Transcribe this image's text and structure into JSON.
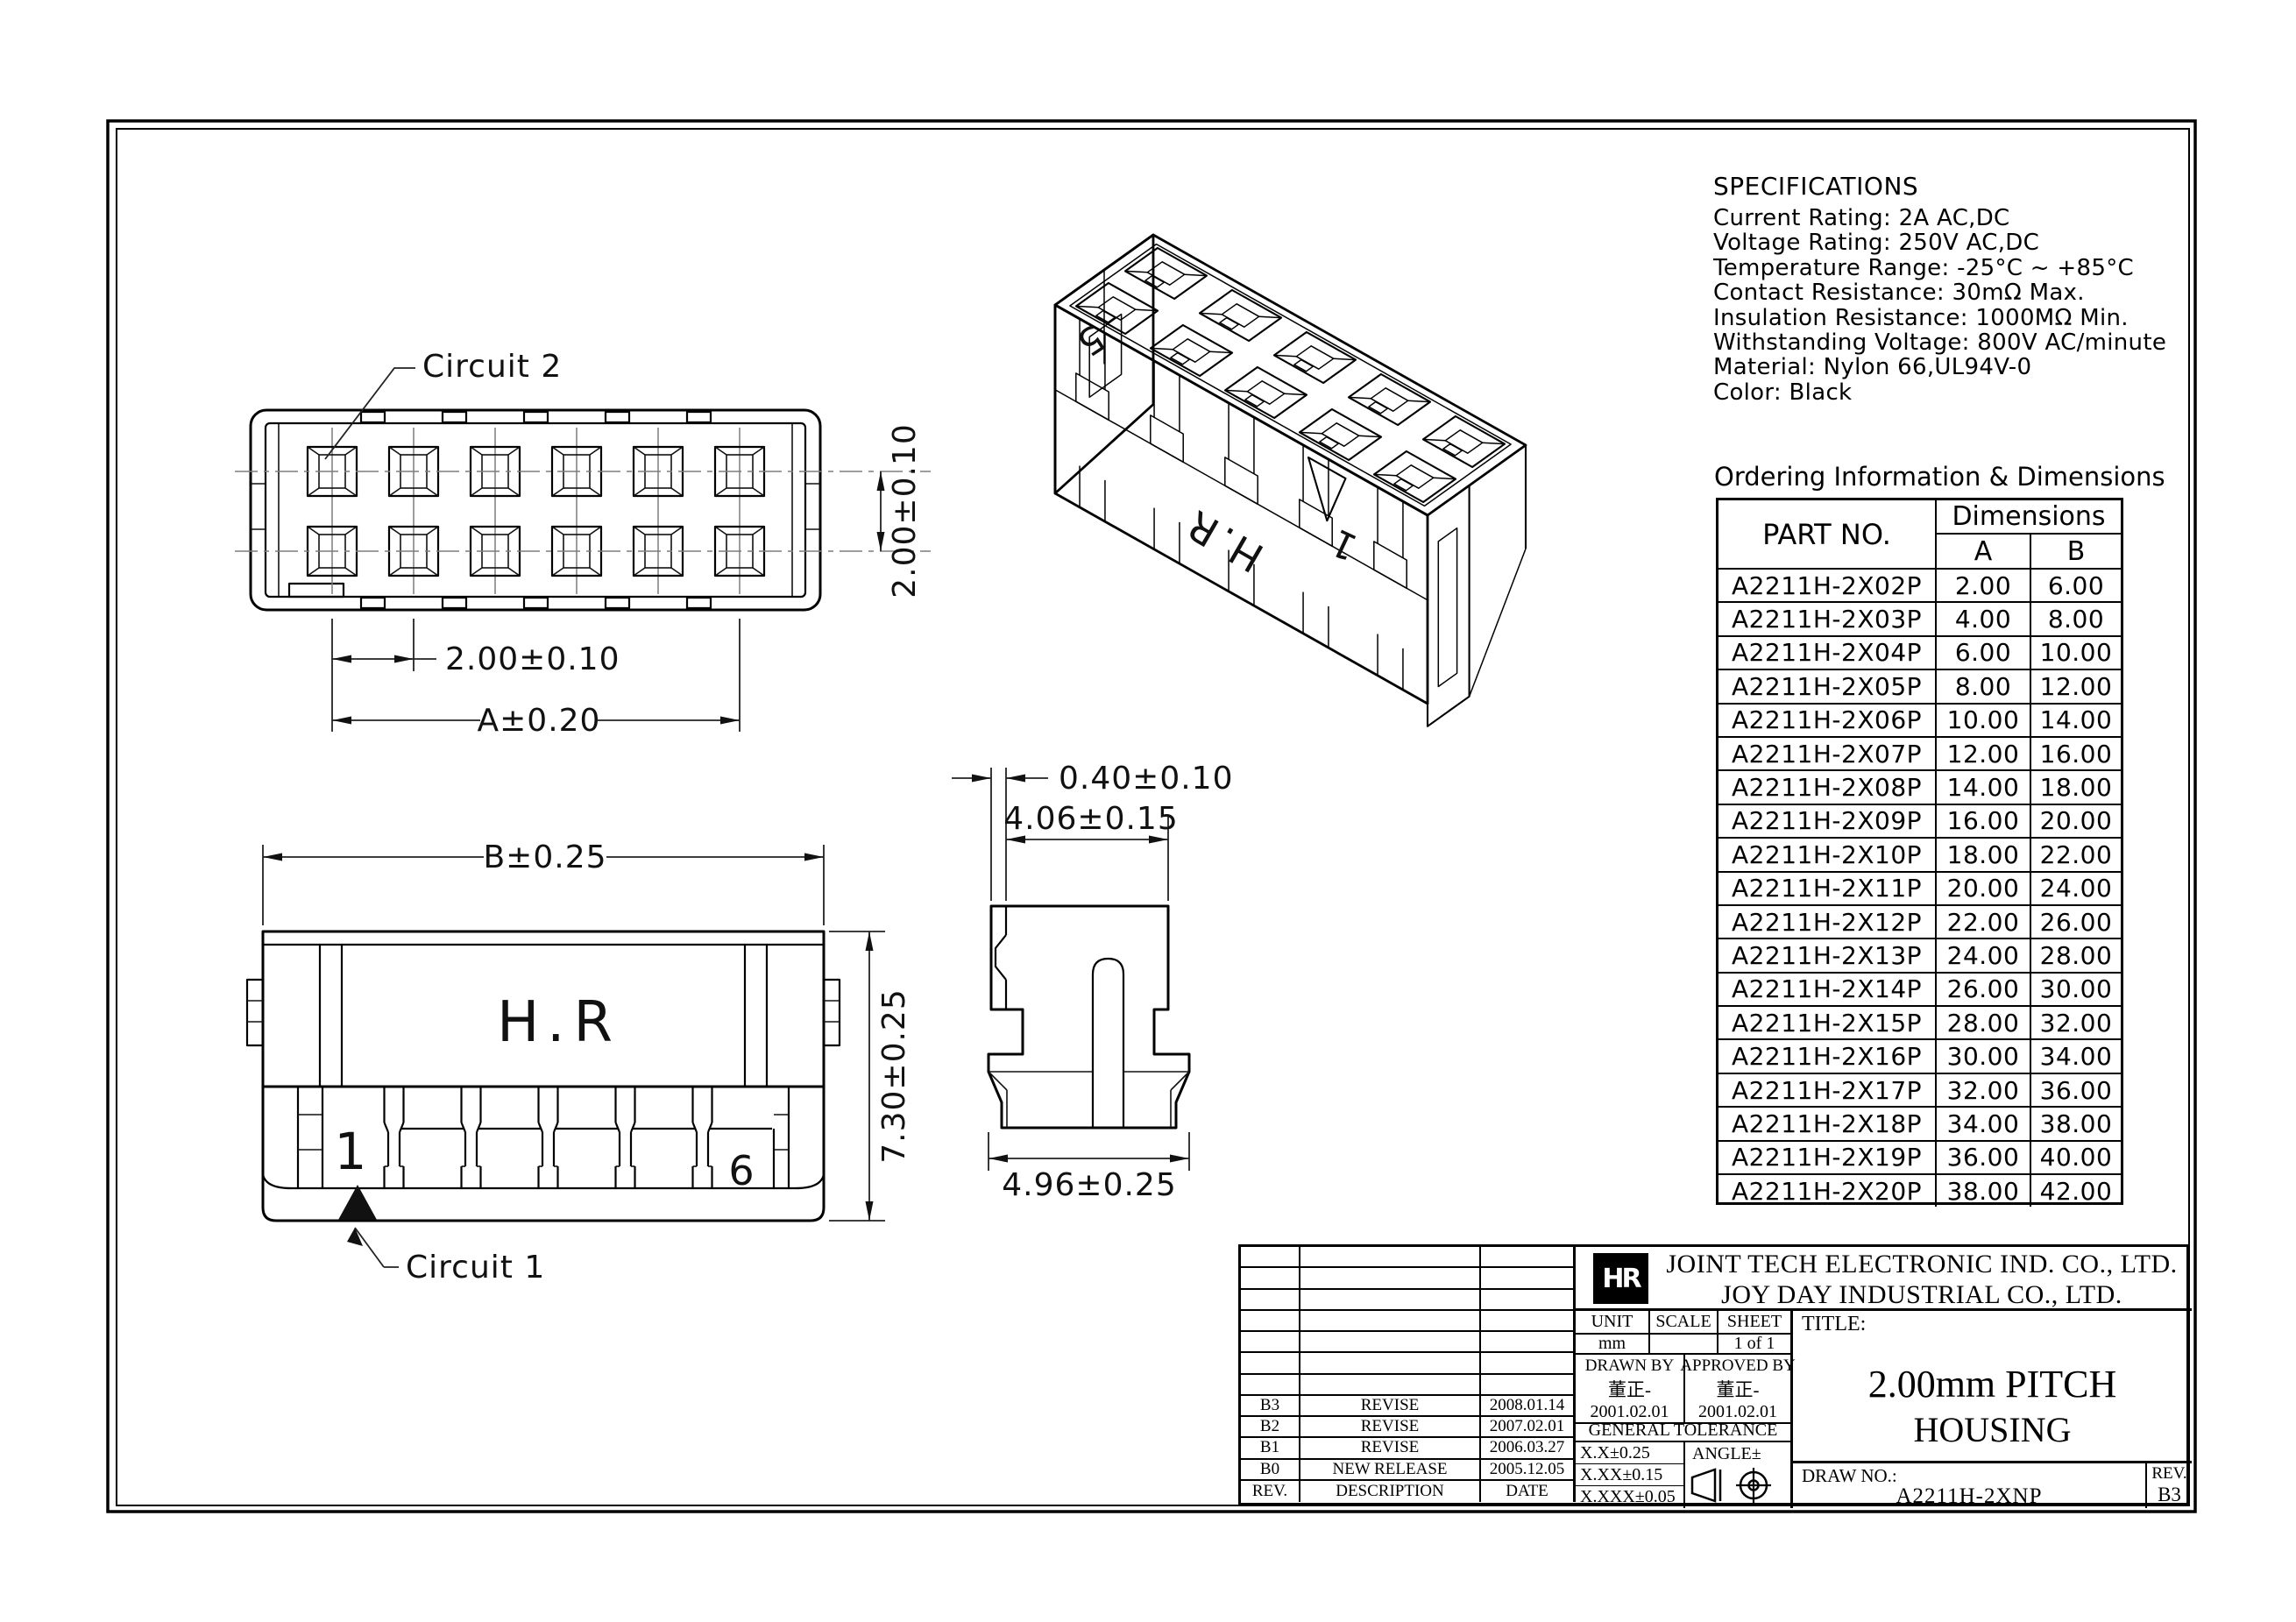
{
  "views": {
    "top_view": {
      "callout": "Circuit 2",
      "dim_pitch": "2.00±0.10",
      "dim_overall": "A±0.20",
      "dim_row_pitch": "2.00±0.10"
    },
    "front_view": {
      "brand_mark": "H.R",
      "first_circuit": "1",
      "last_circuit": "6",
      "callout": "Circuit 1",
      "dim_width": "B±0.25",
      "dim_height": "7.30±0.25"
    },
    "side_view": {
      "dim_wall": "0.40±0.10",
      "dim_upper": "4.06±0.15",
      "dim_base": "4.96±0.25"
    },
    "iso_view": {
      "pin5": "5",
      "pin1": "1",
      "brand": "H.R"
    }
  },
  "specifications": {
    "title": "SPECIFICATIONS",
    "lines": [
      "Current Rating: 2A AC,DC",
      "Voltage Rating: 250V AC,DC",
      "Temperature Range: -25°C ~ +85°C",
      "Contact Resistance: 30mΩ Max.",
      "Insulation Resistance: 1000MΩ Min.",
      "Withstanding Voltage: 800V AC/minute",
      "Material: Nylon 66,UL94V-0",
      "Color: Black"
    ]
  },
  "ordering": {
    "title": "Ordering Information & Dimensions",
    "col_part": "PART NO.",
    "col_dims": "Dimensions",
    "col_a": "A",
    "col_b": "B",
    "rows": [
      {
        "part": "A2211H-2X02P",
        "a": "2.00",
        "b": "6.00"
      },
      {
        "part": "A2211H-2X03P",
        "a": "4.00",
        "b": "8.00"
      },
      {
        "part": "A2211H-2X04P",
        "a": "6.00",
        "b": "10.00"
      },
      {
        "part": "A2211H-2X05P",
        "a": "8.00",
        "b": "12.00"
      },
      {
        "part": "A2211H-2X06P",
        "a": "10.00",
        "b": "14.00"
      },
      {
        "part": "A2211H-2X07P",
        "a": "12.00",
        "b": "16.00"
      },
      {
        "part": "A2211H-2X08P",
        "a": "14.00",
        "b": "18.00"
      },
      {
        "part": "A2211H-2X09P",
        "a": "16.00",
        "b": "20.00"
      },
      {
        "part": "A2211H-2X10P",
        "a": "18.00",
        "b": "22.00"
      },
      {
        "part": "A2211H-2X11P",
        "a": "20.00",
        "b": "24.00"
      },
      {
        "part": "A2211H-2X12P",
        "a": "22.00",
        "b": "26.00"
      },
      {
        "part": "A2211H-2X13P",
        "a": "24.00",
        "b": "28.00"
      },
      {
        "part": "A2211H-2X14P",
        "a": "26.00",
        "b": "30.00"
      },
      {
        "part": "A2211H-2X15P",
        "a": "28.00",
        "b": "32.00"
      },
      {
        "part": "A2211H-2X16P",
        "a": "30.00",
        "b": "34.00"
      },
      {
        "part": "A2211H-2X17P",
        "a": "32.00",
        "b": "36.00"
      },
      {
        "part": "A2211H-2X18P",
        "a": "34.00",
        "b": "38.00"
      },
      {
        "part": "A2211H-2X19P",
        "a": "36.00",
        "b": "40.00"
      },
      {
        "part": "A2211H-2X20P",
        "a": "38.00",
        "b": "42.00"
      }
    ]
  },
  "title_block": {
    "logo_text": "HR",
    "company1": "JOINT TECH ELECTRONIC IND. CO., LTD.",
    "company2": "JOY DAY INDUSTRIAL CO., LTD.",
    "unit_label": "UNIT",
    "unit_value": "mm",
    "scale_label": "SCALE",
    "scale_value": "",
    "sheet_label": "SHEET",
    "sheet_value": "1 of 1",
    "drawn_label": "DRAWN BY",
    "drawn_sign": "董正-",
    "drawn_date": "2001.02.01",
    "approved_label": "APPROVED BY",
    "approved_sign": "董正-",
    "approved_date": "2001.02.01",
    "tolerance_title": "GENERAL TOLERANCE",
    "tol1": "X.X±0.25",
    "tol2": "X.XX±0.15",
    "tol3": "X.XXX±0.05",
    "angle_label": "ANGLE±",
    "title_label": "TITLE:",
    "title_line1": "2.00mm PITCH",
    "title_line2": "HOUSING",
    "drawno_label": "DRAW NO.:",
    "drawno_value": "A2211H-2XNP",
    "rev_label": "REV.",
    "rev_value": "B3",
    "empty_rows": 7,
    "revisions": [
      {
        "rev": "B3",
        "desc": "REVISE",
        "date": "2008.01.14"
      },
      {
        "rev": "B2",
        "desc": "REVISE",
        "date": "2007.02.01"
      },
      {
        "rev": "B1",
        "desc": "REVISE",
        "date": "2006.03.27"
      },
      {
        "rev": "B0",
        "desc": "NEW RELEASE",
        "date": "2005.12.05"
      }
    ],
    "rev_header": {
      "rev": "REV.",
      "desc": "DESCRIPTION",
      "date": "DATE"
    }
  }
}
